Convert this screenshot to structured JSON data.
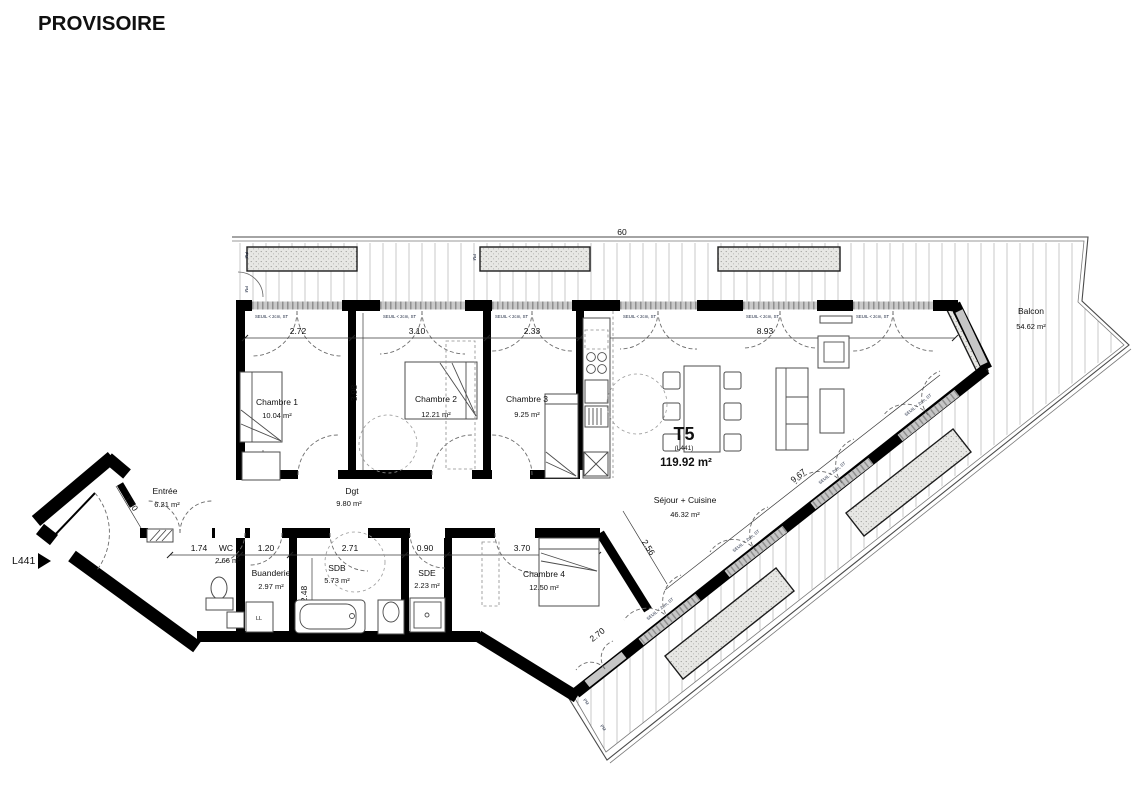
{
  "title": "PROVISOIRE",
  "unit_marker": "L441",
  "apartment": {
    "type": "T5",
    "ref": "(L441)",
    "area": "119.92 m²"
  },
  "rooms": {
    "chambre1": {
      "name": "Chambre 1",
      "area": "10.04 m²"
    },
    "chambre2": {
      "name": "Chambre 2",
      "area": "12.21 m²"
    },
    "chambre3": {
      "name": "Chambre 3",
      "area": "9.25 m²"
    },
    "chambre4": {
      "name": "Chambre 4",
      "area": "12.50 m²"
    },
    "entree": {
      "name": "Entrée",
      "area": "6.21 m²"
    },
    "wc": {
      "name": "WC",
      "area": "2.66 m²"
    },
    "buanderie": {
      "name": "Buanderie",
      "area": "2.97 m²"
    },
    "sdb": {
      "name": "SDB",
      "area": "5.73 m²"
    },
    "sde": {
      "name": "SDE",
      "area": "2.23 m²"
    },
    "dgt": {
      "name": "Dgt",
      "area": "9.80 m²"
    },
    "sejour": {
      "name": "Séjour + Cuisine",
      "area": "46.32 m²"
    },
    "balcon": {
      "name": "Balcon",
      "area": "54.62 m²"
    }
  },
  "dims": {
    "ch1": "2.72",
    "ch2": "3.10",
    "ch3": "2.33",
    "sejour": "8.93",
    "depth": "3.98",
    "nook": "0.60",
    "vest": "1.30",
    "wc": "1.74",
    "bua": "1.20",
    "sdb": "2.71",
    "sde": "0.90",
    "ch4": "3.70",
    "sdb_d": "2.48",
    "sej_diag": "9.67",
    "ch4_diag": "2.56",
    "balc_diag": "2.70",
    "rail": "60"
  },
  "labels": {
    "sill": "SEUIL < 2cm, ST",
    "pm": "PM",
    "washer": "LL"
  }
}
